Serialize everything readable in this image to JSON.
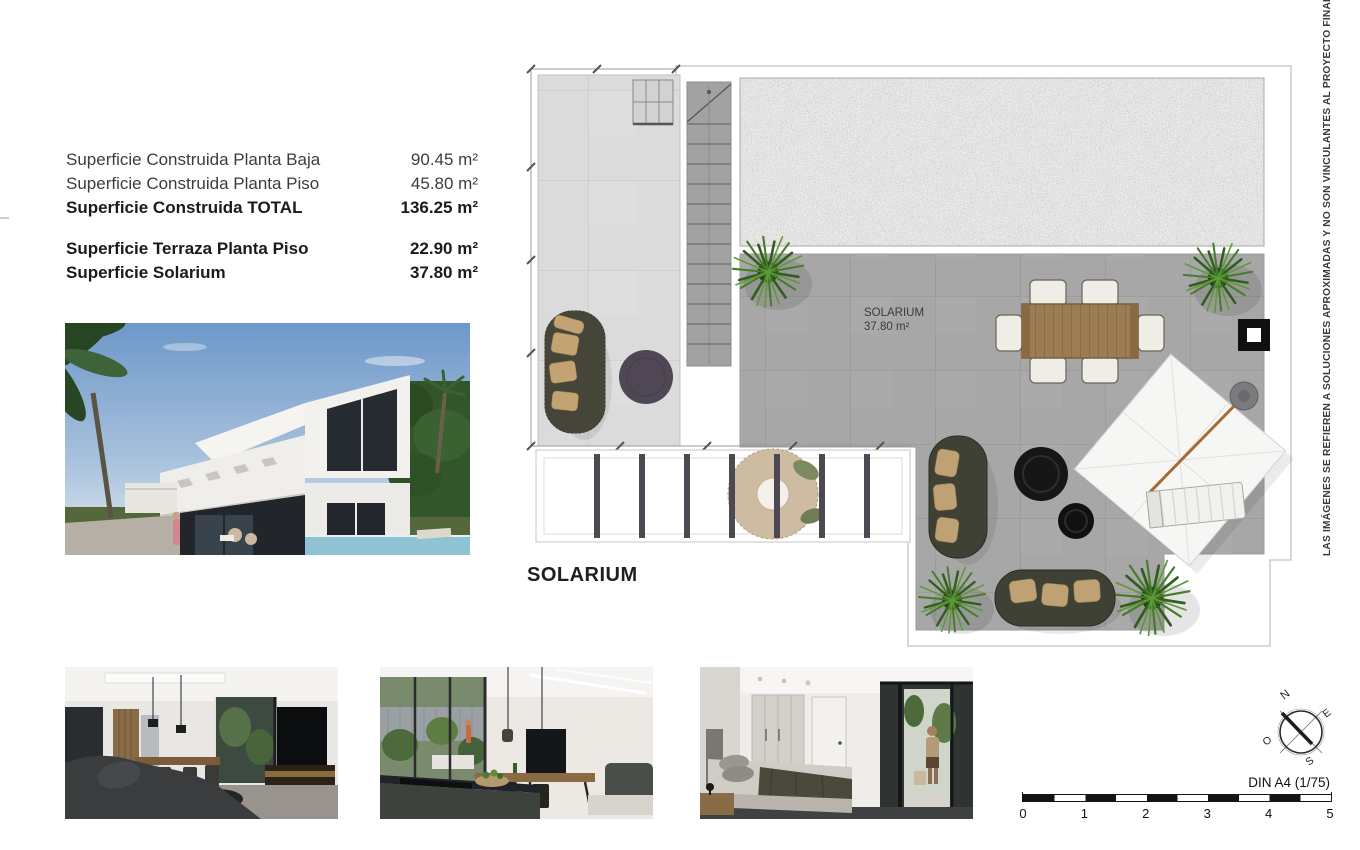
{
  "surface_table": {
    "rows": [
      {
        "label": "Superficie Construida Planta Baja",
        "value": "90.45 m²"
      },
      {
        "label": "Superficie Construida Planta Piso",
        "value": "45.80 m²"
      },
      {
        "label": "Superficie Construida TOTAL",
        "value": "136.25 m²"
      },
      {
        "label": "Superficie Terraza Planta Piso",
        "value": "22.90 m²"
      },
      {
        "label": "Superficie Solarium",
        "value": "37.80 m²"
      }
    ]
  },
  "floorplan": {
    "title": "SOLARIUM",
    "room_label": "SOLARIUM",
    "room_area": "37.80 m²"
  },
  "disclaimer": "LAS IMÁGENES SE REFIEREN A SOLUCIONES APROXIMADAS Y NO SON VINCULANTES AL PROYECTO FINAL",
  "compass": {
    "north": "N",
    "east": "E",
    "south": "S",
    "west": "O"
  },
  "scale_bar": {
    "label": "DIN A4 (1/75)",
    "ticks": [
      "0",
      "1",
      "2",
      "3",
      "4",
      "5"
    ]
  },
  "colors": {
    "page_bg": "#ffffff",
    "solarium_tile": "#a7a7a7",
    "terrace_tile": "#dbdbdb",
    "gravel": "#cdcdcd",
    "pergola_slat": "#4d4953",
    "sofa_olive": "#3e4134",
    "cushion_tan": "#c0a173",
    "plant_green": "#477c2b",
    "table_wood": "#9c7c52",
    "accent_black": "#141414"
  }
}
